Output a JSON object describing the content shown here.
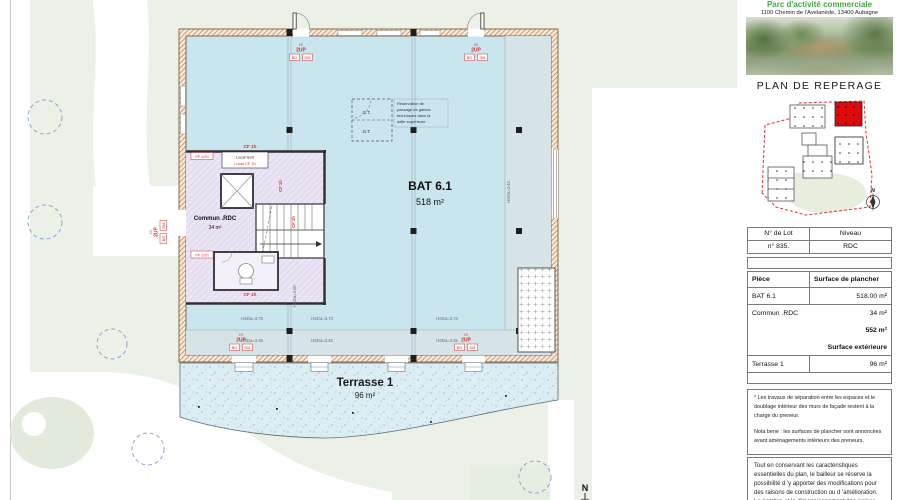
{
  "header": {
    "park_name": "Parc d'activité commerciale",
    "address": "1100 Chemin de l'Avelanède, 13400 Aubagne"
  },
  "panel": {
    "title": "PLAN DE REPERAGE",
    "map_compass": "N",
    "lot_table": {
      "col1": "N° de Lot",
      "col2": "Niveau",
      "lot": "n° 835.",
      "niveau": "RDC"
    },
    "surface_table": {
      "col1": "Pièce",
      "col2": "Surface de plancher",
      "rows": [
        {
          "label": "BAT 6.1",
          "value": "518.00 m²"
        },
        {
          "label": "Commun .RDC",
          "value": "34 m²"
        },
        {
          "label": "",
          "value": "552 m²"
        },
        {
          "label": "",
          "value": "Surface extérieure"
        },
        {
          "label": "Terrasse 1",
          "value": "96 m²"
        }
      ]
    },
    "notes": {
      "note1": "* Les travaux de séparation entre les espaces et le doublage intérieur des murs de façade restent à la charge du preneur.",
      "note2": "Nota bene : les surfaces de plancher sont annoncées avant aménagements intérieurs des preneurs.",
      "note3": "Tout en conservant les caractéristiques essentielles du plan, le bailleur se réserve la possibilité d 'y apporter des modifications pour des raisons de construction ou d 'amélioration. Le nombre et le dimensionnement des gaines, les retombées de faux plafonds, soffites et"
    }
  },
  "plan": {
    "bat": {
      "name": "BAT 6.1",
      "area": "518 m²"
    },
    "commun": {
      "name": "Commun .RDC",
      "area": "34 m²"
    },
    "terrasse": {
      "name": "Terrasse 1",
      "area": "96 m²"
    },
    "compass": "N",
    "labels": {
      "is": "IS",
      "up": "2UP",
      "bg": "BG",
      "dm": "DM",
      "cf1h": "CF 1h",
      "pf12h": "PF 1/2h",
      "local_tech": "Local tech",
      "local_cf": "Local CF 1h",
      "gt": ".G.T.",
      "h373": "HSDa=3.73",
      "h345": "HSDa=3.45",
      "h280": "HSDa=2.80",
      "resa1": "Réservation de",
      "resa2": "passage de gaines",
      "resa3": "techniques dans la",
      "resa4": "dalle supérieure"
    }
  },
  "colors": {
    "accent_green": "#3faa3d",
    "annotation_red": "#cc3333",
    "highlight_red": "#dd0b0b",
    "interior_blue": "#c9e5ee",
    "common_purple": "#ebe4f4"
  }
}
